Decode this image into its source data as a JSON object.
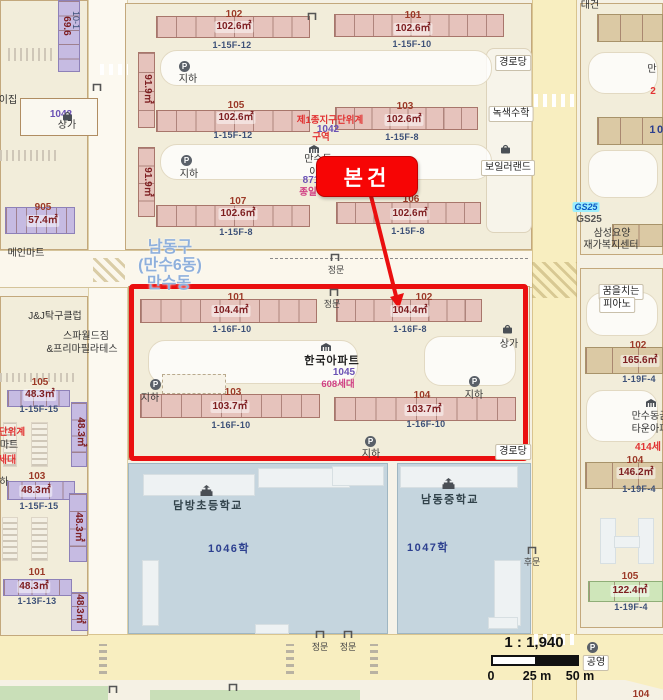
{
  "meta": {
    "subject_label": "본건",
    "scale_ratio": "1 : 1,940",
    "scale_ticks": [
      "0",
      "25 m",
      "50 m"
    ],
    "p_label": "P",
    "accent_red": "#ea0f0f",
    "admin_blue": "#8fb0dc"
  },
  "labels": [
    {
      "n": "bldg-a102-no",
      "t": "102",
      "x": 234,
      "y": 9,
      "c": "bno"
    },
    {
      "n": "bldg-a102-area",
      "t": "102.6㎡",
      "x": 234,
      "y": 21,
      "c": "area"
    },
    {
      "n": "bldg-a102-floors",
      "t": "1-15F-12",
      "x": 232,
      "y": 40,
      "c": "flr"
    },
    {
      "n": "bldg-a-v1-area",
      "t": "91.9㎡",
      "x": 147,
      "y": 89,
      "c": "varea"
    },
    {
      "n": "bldg-a105-no",
      "t": "105",
      "x": 236,
      "y": 100,
      "c": "bno"
    },
    {
      "n": "bldg-a105-area",
      "t": "102.6㎡",
      "x": 236,
      "y": 112,
      "c": "area"
    },
    {
      "n": "bldg-a105-floors",
      "t": "1-15F-12",
      "x": 233,
      "y": 130,
      "c": "flr"
    },
    {
      "n": "bldg-a-v2-area",
      "t": "91.9㎡",
      "x": 147,
      "y": 182,
      "c": "varea"
    },
    {
      "n": "bldg-a107-no",
      "t": "107",
      "x": 238,
      "y": 196,
      "c": "bno"
    },
    {
      "n": "bldg-a107-area",
      "t": "102.6㎡",
      "x": 238,
      "y": 208,
      "c": "area"
    },
    {
      "n": "bldg-a107-floors",
      "t": "1-15F-8",
      "x": 236,
      "y": 227,
      "c": "flr"
    },
    {
      "n": "bldg-a101-no",
      "t": "101",
      "x": 413,
      "y": 10,
      "c": "bno"
    },
    {
      "n": "bldg-a101-area",
      "t": "102.6㎡",
      "x": 413,
      "y": 23,
      "c": "area"
    },
    {
      "n": "bldg-a101-floors",
      "t": "1-15F-10",
      "x": 412,
      "y": 39,
      "c": "flr"
    },
    {
      "n": "bldg-a103-no",
      "t": "103",
      "x": 405,
      "y": 101,
      "c": "bno"
    },
    {
      "n": "bldg-a103-area",
      "t": "102.6㎡",
      "x": 404,
      "y": 114,
      "c": "area"
    },
    {
      "n": "bldg-a103-floors",
      "t": "1-15F-8",
      "x": 402,
      "y": 132,
      "c": "flr"
    },
    {
      "n": "bldg-a106-no",
      "t": "106",
      "x": 411,
      "y": 194,
      "c": "bno"
    },
    {
      "n": "bldg-a106-area",
      "t": "102.6㎡",
      "x": 410,
      "y": 208,
      "c": "area"
    },
    {
      "n": "bldg-a106-floors",
      "t": "1-15F-8",
      "x": 408,
      "y": 226,
      "c": "flr"
    },
    {
      "n": "underground-1",
      "t": "지하",
      "x": 188,
      "y": 74,
      "c": "plc"
    },
    {
      "n": "underground-2",
      "t": "지하",
      "x": 189,
      "y": 169,
      "c": "plc"
    },
    {
      "n": "district-plan-line1",
      "t": "제1종지구단위계",
      "x": 330,
      "y": 116,
      "c": "red"
    },
    {
      "n": "lot-1042",
      "t": "1042",
      "x": 328,
      "y": 124,
      "c": "lot"
    },
    {
      "n": "district-plan-line2",
      "t": "구역",
      "x": 321,
      "y": 133,
      "c": "red"
    },
    {
      "n": "mansu-apt-name1",
      "t": "만수동",
      "x": 318,
      "y": 154,
      "c": "plc"
    },
    {
      "n": "mansu-apt-name2",
      "t": "아",
      "x": 314,
      "y": 167,
      "c": "plc"
    },
    {
      "n": "lot-871",
      "t": "871",
      "x": 311,
      "y": 175,
      "c": "lot"
    },
    {
      "n": "jongil-text",
      "t": "종일",
      "x": 308,
      "y": 188,
      "c": "mag"
    },
    {
      "n": "senior-center-top",
      "t": "경로당",
      "x": 513,
      "y": 55,
      "c": "chip"
    },
    {
      "n": "noksaek-math",
      "t": "녹색수학",
      "x": 511,
      "y": 106,
      "c": "chip"
    },
    {
      "n": "boiler-land",
      "t": "보일러랜드",
      "x": 508,
      "y": 160,
      "c": "chip"
    },
    {
      "n": "gs25-logo-text",
      "t": "GS25",
      "x": 586,
      "y": 202,
      "c": "gsl"
    },
    {
      "n": "gs25-name",
      "t": "GS25",
      "x": 589,
      "y": 214,
      "c": "gray"
    },
    {
      "n": "samsung-care-1",
      "t": "삼성요양",
      "x": 612,
      "y": 228,
      "c": "plc"
    },
    {
      "n": "samsung-care-2",
      "t": "재가복지센터",
      "x": 611,
      "y": 240,
      "c": "plc"
    },
    {
      "n": "frag-man",
      "t": "만",
      "x": 652,
      "y": 64,
      "c": "plc"
    },
    {
      "n": "frag-2",
      "t": "2",
      "x": 653,
      "y": 86,
      "c": "redb"
    },
    {
      "n": "frag-10",
      "t": "10",
      "x": 657,
      "y": 124,
      "c": "lotb"
    },
    {
      "n": "admin-district",
      "t": "남동구",
      "x": 170,
      "y": 239,
      "c": "adm"
    },
    {
      "n": "admin-subdistrict",
      "t": "(만수6동)",
      "x": 170,
      "y": 257,
      "c": "adm"
    },
    {
      "n": "admin-neighborhood",
      "t": "만수동",
      "x": 169,
      "y": 275,
      "c": "adm"
    },
    {
      "n": "gate-mid-label",
      "t": "정문",
      "x": 336,
      "y": 265,
      "c": "gt"
    },
    {
      "n": "bldg-b101-no",
      "t": "101",
      "x": 236,
      "y": 292,
      "c": "bno"
    },
    {
      "n": "bldg-b101-area",
      "t": "104.4㎡",
      "x": 231,
      "y": 305,
      "c": "area"
    },
    {
      "n": "bldg-b101-floors",
      "t": "1-16F-10",
      "x": 232,
      "y": 324,
      "c": "flr"
    },
    {
      "n": "gate-box-label",
      "t": "정문",
      "x": 332,
      "y": 299,
      "c": "gt"
    },
    {
      "n": "bldg-b102-no",
      "t": "102",
      "x": 424,
      "y": 292,
      "c": "bno"
    },
    {
      "n": "bldg-b102-area",
      "t": "104.4㎡",
      "x": 410,
      "y": 305,
      "c": "area"
    },
    {
      "n": "bldg-b102-floors",
      "t": "1-16F-8",
      "x": 410,
      "y": 324,
      "c": "flr"
    },
    {
      "n": "underground-3",
      "t": "지하",
      "x": 150,
      "y": 393,
      "c": "plc"
    },
    {
      "n": "hanguk-apt-name",
      "t": "한국아파트",
      "x": 332,
      "y": 355,
      "c": "plc12"
    },
    {
      "n": "lot-1045",
      "t": "1045",
      "x": 344,
      "y": 367,
      "c": "lot"
    },
    {
      "n": "households-608",
      "t": "608세대",
      "x": 338,
      "y": 380,
      "c": "mag"
    },
    {
      "n": "shops-box",
      "t": "상가",
      "x": 509,
      "y": 339,
      "c": "plc"
    },
    {
      "n": "underground-4",
      "t": "지하",
      "x": 474,
      "y": 390,
      "c": "plc"
    },
    {
      "n": "bldg-b103-no",
      "t": "103",
      "x": 233,
      "y": 387,
      "c": "bno"
    },
    {
      "n": "bldg-b103-area",
      "t": "103.7㎡",
      "x": 230,
      "y": 401,
      "c": "area"
    },
    {
      "n": "bldg-b103-floors",
      "t": "1-16F-10",
      "x": 231,
      "y": 420,
      "c": "flr"
    },
    {
      "n": "bldg-b104-no",
      "t": "104",
      "x": 422,
      "y": 390,
      "c": "bno"
    },
    {
      "n": "bldg-b104-area",
      "t": "103.7㎡",
      "x": 424,
      "y": 404,
      "c": "area"
    },
    {
      "n": "bldg-b104-floors",
      "t": "1-16F-10",
      "x": 426,
      "y": 419,
      "c": "flr"
    },
    {
      "n": "underground-5",
      "t": "지하",
      "x": 371,
      "y": 449,
      "c": "plc"
    },
    {
      "n": "senior-center-2",
      "t": "경로당",
      "x": 513,
      "y": 444,
      "c": "chip"
    },
    {
      "n": "main-mart",
      "t": "메인마트",
      "x": 26,
      "y": 248,
      "c": "plc"
    },
    {
      "n": "jnj-pingpong",
      "t": "J&J탁구클럽",
      "x": 55,
      "y": 311,
      "c": "plc"
    },
    {
      "n": "spa-world-gym",
      "t": "스파월드짐",
      "x": 86,
      "y": 331,
      "c": "plc"
    },
    {
      "n": "prima-pilates",
      "t": "&프리마필라테스",
      "x": 82,
      "y": 344,
      "c": "plc"
    },
    {
      "n": "bldg-c105-no",
      "t": "105",
      "x": 40,
      "y": 377,
      "c": "bno"
    },
    {
      "n": "bldg-c105-area",
      "t": "48.3㎡",
      "x": 40,
      "y": 389,
      "c": "area"
    },
    {
      "n": "bldg-c105-floors",
      "t": "1-15F-15",
      "x": 39,
      "y": 404,
      "c": "flr"
    },
    {
      "n": "bldg-c-v1-area",
      "t": "48.3㎡",
      "x": 80,
      "y": 432,
      "c": "varea"
    },
    {
      "n": "edge-danwigye",
      "t": "단위계",
      "x": 12,
      "y": 428,
      "c": "red"
    },
    {
      "n": "edge-mart",
      "t": "마트",
      "x": 9,
      "y": 440,
      "c": "plc"
    },
    {
      "n": "edge-sedae",
      "t": "세대",
      "x": 7,
      "y": 455,
      "c": "redb"
    },
    {
      "n": "bldg-c103-no",
      "t": "103",
      "x": 37,
      "y": 471,
      "c": "bno"
    },
    {
      "n": "bldg-c103-area",
      "t": "48.3㎡",
      "x": 36,
      "y": 485,
      "c": "area"
    },
    {
      "n": "bldg-c103-floors",
      "t": "1-15F-15",
      "x": 39,
      "y": 501,
      "c": "flr"
    },
    {
      "n": "bldg-c-v2-area",
      "t": "48.3㎡",
      "x": 78,
      "y": 527,
      "c": "varea"
    },
    {
      "n": "edge-ha",
      "t": "하",
      "x": 4,
      "y": 477,
      "c": "plc"
    },
    {
      "n": "bldg-c101-no",
      "t": "101",
      "x": 37,
      "y": 567,
      "c": "bno"
    },
    {
      "n": "bldg-c101-area",
      "t": "48.3㎡",
      "x": 34,
      "y": 581,
      "c": "area"
    },
    {
      "n": "bldg-c101-floors",
      "t": "1-13F-13",
      "x": 37,
      "y": 596,
      "c": "flr"
    },
    {
      "n": "bldg-c-v3-area",
      "t": "48.3㎡",
      "x": 79,
      "y": 609,
      "c": "varea"
    },
    {
      "n": "bldg-905-no",
      "t": "905",
      "x": 43,
      "y": 202,
      "c": "bno"
    },
    {
      "n": "bldg-905-area",
      "t": "57.4㎡",
      "x": 43,
      "y": 215,
      "c": "area"
    },
    {
      "n": "bldg-tl-v-area",
      "t": "69.6",
      "x": 66,
      "y": 26,
      "c": "varea"
    },
    {
      "n": "bldg-tl-v-floors",
      "t": "10-1",
      "x": 76,
      "y": 20,
      "c": "vflr"
    },
    {
      "n": "lot-1043",
      "t": "1043",
      "x": 61,
      "y": 109,
      "c": "lot"
    },
    {
      "n": "shops-topleft",
      "t": "상가",
      "x": 67,
      "y": 120,
      "c": "plc"
    },
    {
      "n": "edge-ijip",
      "t": "이집",
      "x": 8,
      "y": 95,
      "c": "plc"
    },
    {
      "n": "dambang-elementary",
      "t": "담방초등학교",
      "x": 208,
      "y": 500,
      "c": "sch"
    },
    {
      "n": "lot-1046-hak",
      "t": "1046학",
      "x": 229,
      "y": 543,
      "c": "lotb"
    },
    {
      "n": "namdong-middle",
      "t": "남동중학교",
      "x": 450,
      "y": 494,
      "c": "sch"
    },
    {
      "n": "lot-1047-hak",
      "t": "1047학",
      "x": 428,
      "y": 542,
      "c": "lotb"
    },
    {
      "n": "gate-back-label",
      "t": "후문",
      "x": 532,
      "y": 557,
      "c": "gt"
    },
    {
      "n": "gate-bottom1-label",
      "t": "정문",
      "x": 320,
      "y": 642,
      "c": "gt"
    },
    {
      "n": "gate-bottom2-label",
      "t": "정문",
      "x": 348,
      "y": 642,
      "c": "gt"
    },
    {
      "n": "dream-piano-1",
      "t": "꿈을치는",
      "x": 621,
      "y": 284,
      "c": "chip"
    },
    {
      "n": "dream-piano-2",
      "t": "피아노",
      "x": 617,
      "y": 297,
      "c": "chip"
    },
    {
      "n": "bldg-d102-no",
      "t": "102",
      "x": 638,
      "y": 340,
      "c": "bno"
    },
    {
      "n": "bldg-d102-area",
      "t": "165.6㎡",
      "x": 640,
      "y": 355,
      "c": "area"
    },
    {
      "n": "bldg-d102-floors",
      "t": "1-19F-4",
      "x": 639,
      "y": 374,
      "c": "flr"
    },
    {
      "n": "town-apt-name1",
      "t": "만수동금",
      "x": 650,
      "y": 411,
      "c": "plc"
    },
    {
      "n": "town-apt-name2",
      "t": "타운아파",
      "x": 650,
      "y": 424,
      "c": "plc"
    },
    {
      "n": "households-414",
      "t": "414세",
      "x": 648,
      "y": 442,
      "c": "redb"
    },
    {
      "n": "bldg-d104-no",
      "t": "104",
      "x": 635,
      "y": 455,
      "c": "bno"
    },
    {
      "n": "bldg-d104-area",
      "t": "146.2㎡",
      "x": 636,
      "y": 467,
      "c": "area"
    },
    {
      "n": "bldg-d104-floors",
      "t": "1-19F-4",
      "x": 639,
      "y": 484,
      "c": "flr"
    },
    {
      "n": "bldg-d105-no",
      "t": "105",
      "x": 630,
      "y": 571,
      "c": "bno"
    },
    {
      "n": "bldg-d105-area",
      "t": "122.4㎡",
      "x": 630,
      "y": 585,
      "c": "area"
    },
    {
      "n": "bldg-d105-floors",
      "t": "1-19F-4",
      "x": 631,
      "y": 602,
      "c": "flr"
    },
    {
      "n": "public-parking",
      "t": "공영",
      "x": 596,
      "y": 655,
      "c": "chip"
    },
    {
      "n": "frag-104-bottom",
      "t": "104",
      "x": 641,
      "y": 689,
      "c": "bno"
    },
    {
      "n": "frag-daegeon",
      "t": "대건",
      "x": 590,
      "y": 0,
      "c": "plc"
    }
  ],
  "buildings": [
    {
      "n": "row-a102",
      "x": 156,
      "y": 16,
      "w": 154,
      "h": 22,
      "c": "p",
      "s": 8
    },
    {
      "n": "row-a105",
      "x": 156,
      "y": 110,
      "w": 154,
      "h": 22,
      "c": "p",
      "s": 8
    },
    {
      "n": "row-a107",
      "x": 156,
      "y": 205,
      "w": 154,
      "h": 22,
      "c": "p",
      "s": 8
    },
    {
      "n": "row-a101",
      "x": 334,
      "y": 14,
      "w": 170,
      "h": 23,
      "c": "p",
      "s": 9
    },
    {
      "n": "row-a103",
      "x": 335,
      "y": 107,
      "w": 143,
      "h": 23,
      "c": "p",
      "s": 8
    },
    {
      "n": "row-a106",
      "x": 336,
      "y": 202,
      "w": 145,
      "h": 22,
      "c": "p",
      "s": 8
    },
    {
      "n": "strip-a-v1",
      "x": 138,
      "y": 52,
      "w": 17,
      "h": 76,
      "c": "p",
      "s": 4,
      "v": true
    },
    {
      "n": "strip-a-v2",
      "x": 138,
      "y": 147,
      "w": 17,
      "h": 70,
      "c": "p",
      "s": 4,
      "v": true
    },
    {
      "n": "row-b101",
      "x": 140,
      "y": 299,
      "w": 177,
      "h": 24,
      "c": "p",
      "s": 9
    },
    {
      "n": "row-b102",
      "x": 336,
      "y": 299,
      "w": 146,
      "h": 23,
      "c": "p",
      "s": 8
    },
    {
      "n": "row-b103",
      "x": 140,
      "y": 394,
      "w": 180,
      "h": 24,
      "c": "p",
      "s": 9
    },
    {
      "n": "row-b104",
      "x": 334,
      "y": 397,
      "w": 182,
      "h": 24,
      "c": "p",
      "s": 9
    },
    {
      "n": "strip-c-top",
      "x": 58,
      "y": 0,
      "w": 22,
      "h": 72,
      "c": "u",
      "s": 5,
      "v": true
    },
    {
      "n": "row-905",
      "x": 5,
      "y": 207,
      "w": 70,
      "h": 27,
      "c": "u",
      "s": 7
    },
    {
      "n": "row-c105",
      "x": 7,
      "y": 390,
      "w": 63,
      "h": 17,
      "c": "u",
      "s": 5
    },
    {
      "n": "strip-c-v1",
      "x": 71,
      "y": 402,
      "w": 16,
      "h": 65,
      "c": "u",
      "s": 4,
      "v": true
    },
    {
      "n": "row-c103",
      "x": 7,
      "y": 481,
      "w": 68,
      "h": 19,
      "c": "u",
      "s": 5
    },
    {
      "n": "strip-c-v2",
      "x": 69,
      "y": 493,
      "w": 18,
      "h": 69,
      "c": "u",
      "s": 4,
      "v": true
    },
    {
      "n": "row-c101",
      "x": 3,
      "y": 579,
      "w": 69,
      "h": 17,
      "c": "u",
      "s": 5
    },
    {
      "n": "strip-c-v3",
      "x": 71,
      "y": 592,
      "w": 17,
      "h": 39,
      "c": "u",
      "s": 3,
      "v": true
    },
    {
      "n": "row-t1",
      "x": 597,
      "y": 14,
      "w": 66,
      "h": 28,
      "c": "t",
      "s": 3
    },
    {
      "n": "row-t2",
      "x": 597,
      "y": 117,
      "w": 66,
      "h": 28,
      "c": "t",
      "s": 3
    },
    {
      "n": "row-t3",
      "x": 612,
      "y": 224,
      "w": 51,
      "h": 23,
      "c": "t",
      "s": 2
    },
    {
      "n": "row-d102",
      "x": 585,
      "y": 347,
      "w": 78,
      "h": 27,
      "c": "t",
      "s": 3
    },
    {
      "n": "row-d104",
      "x": 585,
      "y": 462,
      "w": 78,
      "h": 27,
      "c": "t",
      "s": 3
    },
    {
      "n": "row-d105",
      "x": 588,
      "y": 581,
      "w": 75,
      "h": 21,
      "c": "g",
      "s": 3
    }
  ],
  "icons": [
    {
      "n": "parking-icon-1",
      "t": "p",
      "x": 179,
      "y": 61
    },
    {
      "n": "parking-icon-2",
      "t": "p",
      "x": 181,
      "y": 155
    },
    {
      "n": "parking-icon-3",
      "t": "p",
      "x": 150,
      "y": 379
    },
    {
      "n": "parking-icon-4",
      "t": "p",
      "x": 469,
      "y": 376
    },
    {
      "n": "parking-icon-5",
      "t": "p",
      "x": 365,
      "y": 436
    },
    {
      "n": "parking-icon-public",
      "t": "p",
      "x": 587,
      "y": 642
    },
    {
      "n": "gate-icon-topleft",
      "t": "gate",
      "x": 92,
      "y": 83
    },
    {
      "n": "gate-icon-topright",
      "t": "gate",
      "x": 307,
      "y": 12
    },
    {
      "n": "gate-icon-mid",
      "t": "gate",
      "x": 330,
      "y": 253
    },
    {
      "n": "gate-icon-box",
      "t": "gate",
      "x": 329,
      "y": 288
    },
    {
      "n": "gate-icon-back",
      "t": "gate",
      "x": 527,
      "y": 546
    },
    {
      "n": "gate-icon-bottom1",
      "t": "gate",
      "x": 315,
      "y": 630
    },
    {
      "n": "gate-icon-bottom2",
      "t": "gate",
      "x": 343,
      "y": 630
    },
    {
      "n": "gate-icon-small1",
      "t": "gate",
      "x": 108,
      "y": 685
    },
    {
      "n": "gate-icon-small2",
      "t": "gate",
      "x": 228,
      "y": 683
    },
    {
      "n": "school-icon-dambang",
      "t": "school",
      "x": 200,
      "y": 485
    },
    {
      "n": "school-icon-namdong",
      "t": "school",
      "x": 442,
      "y": 478
    },
    {
      "n": "bag-icon-boiler",
      "t": "bag",
      "x": 500,
      "y": 144
    },
    {
      "n": "bag-icon-shops",
      "t": "bag",
      "x": 502,
      "y": 324
    },
    {
      "n": "bag-icon-topleft",
      "t": "bag",
      "x": 62,
      "y": 111
    },
    {
      "n": "apartment-icon-1",
      "t": "apt",
      "x": 309,
      "y": 145
    },
    {
      "n": "apartment-icon-hanguk",
      "t": "apt",
      "x": 321,
      "y": 343
    },
    {
      "n": "apartment-icon-town",
      "t": "apt",
      "x": 646,
      "y": 399
    }
  ]
}
